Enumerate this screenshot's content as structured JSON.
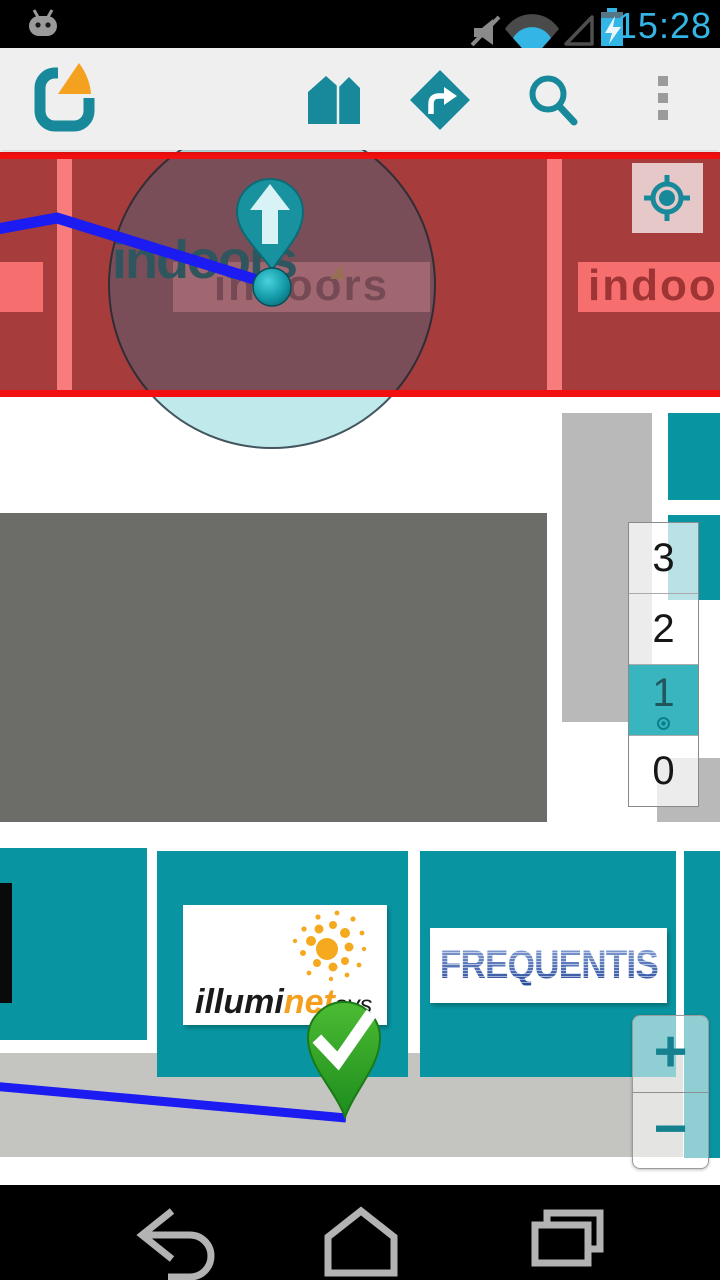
{
  "status_bar": {
    "time": "15:28",
    "icons": [
      "android-robot-icon",
      "mute-icon",
      "wifi-icon",
      "signal-icon",
      "battery-charging-icon"
    ]
  },
  "toolbar": {
    "app_name": "indoo.rs",
    "icons": [
      "app-logo",
      "venues-icon",
      "directions-icon",
      "search-icon",
      "overflow-menu-icon"
    ]
  },
  "map": {
    "banner_text": "indoors",
    "banner_left_text": "indoors",
    "banner_right_text": "indoors",
    "store_label": "indoors",
    "floor_selector": {
      "floors": [
        {
          "label": "3"
        },
        {
          "label": "2"
        },
        {
          "label": "1"
        },
        {
          "label": "0"
        }
      ],
      "selected_label": "1"
    },
    "zoom_in": "+",
    "zoom_out": "−",
    "logo_illuminet": {
      "part_black": "illumi",
      "part_orange": "net",
      "part_suffix": "sys"
    },
    "logo_frequentis": "FREQUENTIS",
    "markers": [
      "current-location-marker",
      "destination-marker"
    ]
  },
  "nav_bar": {
    "icons": [
      "back-icon",
      "home-icon",
      "recents-icon"
    ]
  },
  "colors": {
    "accent_teal": "#17899a",
    "selected_floor_teal": "#39b5c0",
    "route_blue": "#1b1bf2",
    "destination_green": "#2fa32a",
    "band_red": "#a63c3c",
    "band_border_red": "#f10f0f",
    "banner_pink": "#f66e6e",
    "status_blue": "#33b5e5",
    "logo_orange": "#f4a11f"
  }
}
